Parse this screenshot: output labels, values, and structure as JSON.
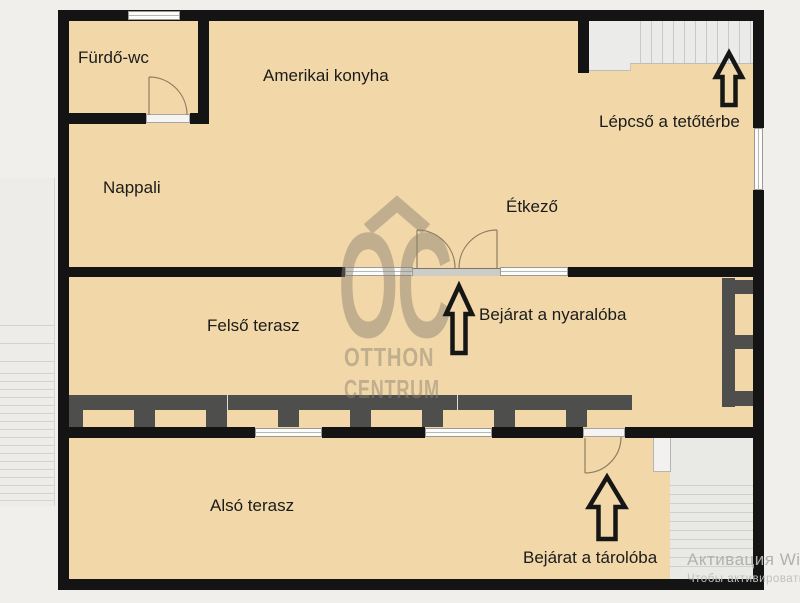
{
  "rooms": {
    "furdo_wc": "Fürdő-wc",
    "amerikai_konyha": "Amerikai konyha",
    "nappali": "Nappali",
    "etkezo": "Étkező",
    "felso_terasz": "Felső terasz",
    "also_terasz": "Alsó terasz"
  },
  "annotations": {
    "lepcso_tetoterbe": "Lépcső a tetőtérbe",
    "bejarat_nyaraloba": "Bejárat a nyaralóba",
    "bejarat_taroloba": "Bejárat a tárolóba"
  },
  "watermark": {
    "logo_initials": "OC",
    "line1": "OTTHON",
    "line2": "CENTRUM"
  },
  "os_watermark": {
    "line1": "Активация Windows",
    "line2": "Чтобы активировать Windows, перейдите"
  },
  "colors": {
    "background": "#f1efeb",
    "floor": "#f2d8a8",
    "wall": "#141414",
    "railing": "#4e4e4c",
    "stairs": "#ebebe9"
  }
}
